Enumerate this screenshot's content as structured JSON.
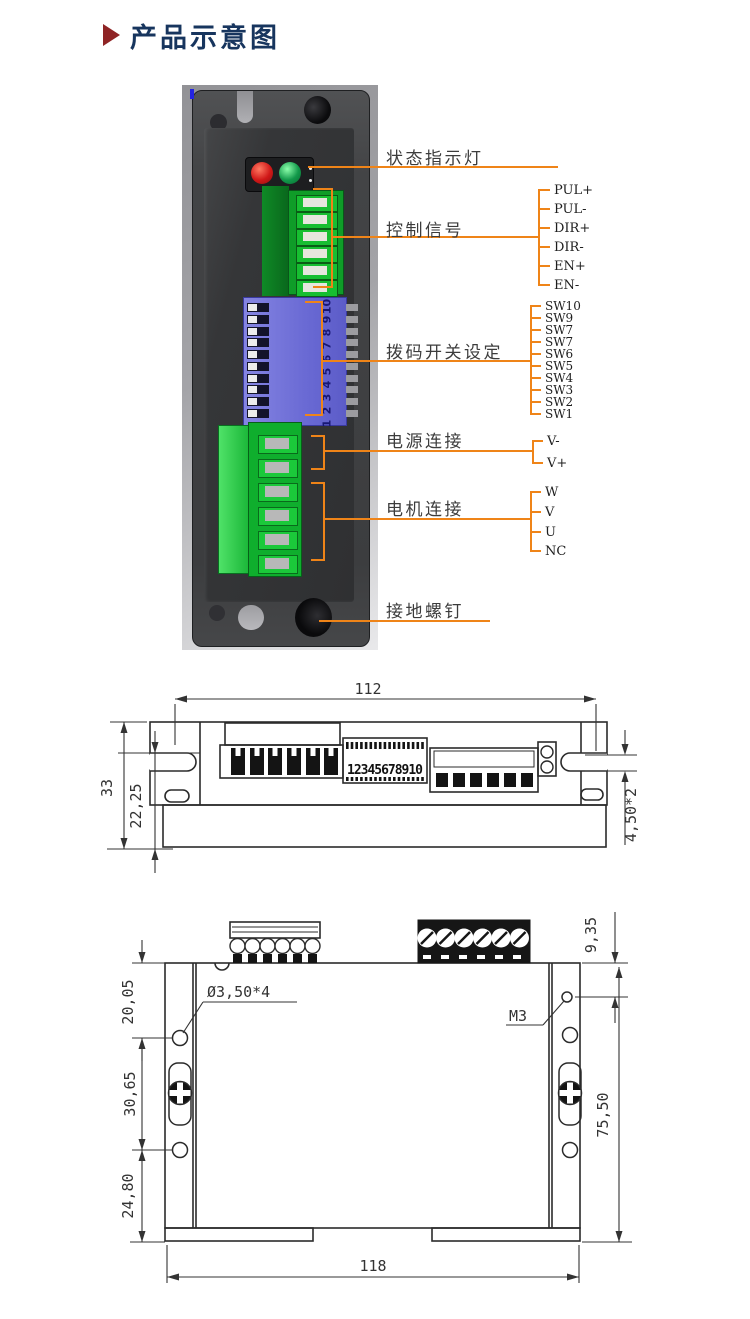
{
  "title": {
    "text": "产品示意图"
  },
  "photo": {
    "callouts": {
      "status": "状态指示灯",
      "control": "控制信号",
      "dip": "拨码开关设定",
      "power": "电源连接",
      "motor": "电机连接",
      "ground": "接地螺钉"
    },
    "control_pins": [
      "PUL+",
      "PUL-",
      "DIR+",
      "DIR-",
      "EN+",
      "EN-"
    ],
    "dip_pins": [
      "SW10",
      "SW9",
      "SW7",
      "SW7",
      "SW6",
      "SW5",
      "SW4",
      "SW3",
      "SW2",
      "SW1"
    ],
    "power_pins": [
      "V-",
      "V+"
    ],
    "motor_pins": [
      "W",
      "V",
      "U",
      "NC"
    ],
    "dip_scale": [
      "10",
      "9",
      "8",
      "7",
      "6",
      "5",
      "4",
      "3",
      "2",
      "1"
    ]
  },
  "drawing_top": {
    "dip_numbers": "12345678910",
    "dims": {
      "width": "112",
      "height": "33",
      "inner_height": "22,25",
      "slot": "4,50*2"
    }
  },
  "drawing_front": {
    "dims": {
      "hole_top": "20,05",
      "hole_mid": "30,65",
      "hole_bottom": "24,80",
      "height": "75,50",
      "connector_offset": "9,35",
      "width": "118"
    },
    "labels": {
      "hole_spec": "Ø3,50*4",
      "thread_spec": "M3"
    }
  },
  "colors": {
    "callout_orange": "#ef8418",
    "title_navy": "#17355e",
    "title_arrow_red": "#8f2425",
    "led_red": "#d01818",
    "led_green": "#12984a",
    "connector_green": "#0f9c28",
    "dip_blue": "#6a6ad4",
    "drawing_line": "#2b2b2b"
  }
}
